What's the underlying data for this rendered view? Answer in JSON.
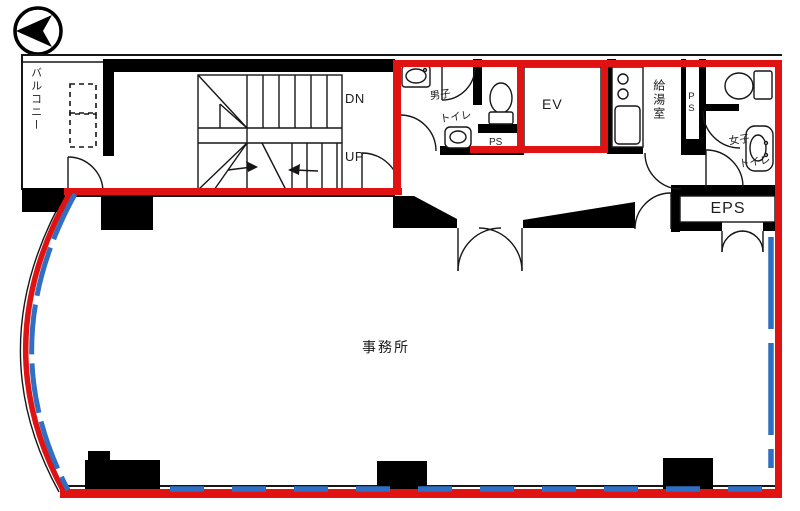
{
  "plan_type": "floor-plan",
  "colors": {
    "red": "#e11212",
    "blue": "#2f6fc4",
    "black": "#000000"
  },
  "labels": {
    "balcony": "バルコニー",
    "dn": "DN",
    "up": "UP",
    "mens_line1": "男子",
    "mens_line2": "トイレ",
    "ps_mens": "PS",
    "ev": "EV",
    "kitchenette": "給湯室",
    "ps_shaft": "PS",
    "womens_line1": "女子",
    "womens_line2": "トイレ",
    "eps": "EPS",
    "office": "事務所"
  }
}
